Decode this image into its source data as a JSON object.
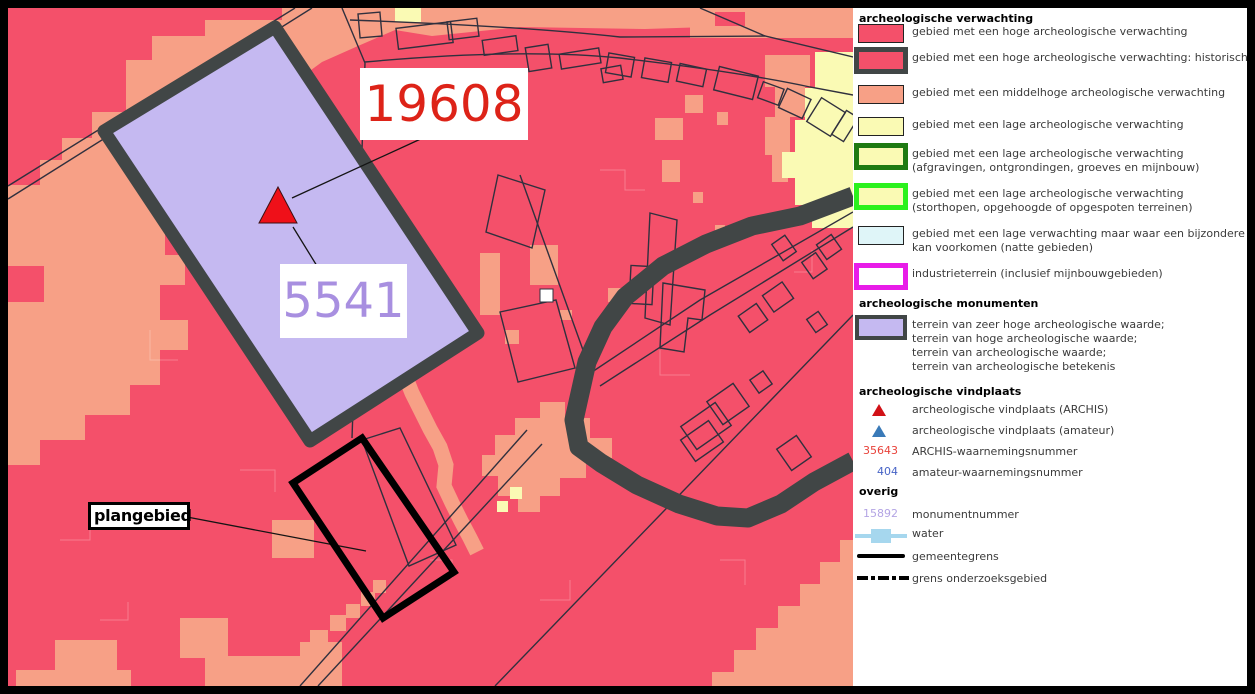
{
  "map": {
    "labels": {
      "archis_number": "19608",
      "monument_number": "5541",
      "plan_area": "plangebied"
    },
    "colors": {
      "high_expectation_red": "#f4506a",
      "medium_expectation_salmon": "#f7a086",
      "low_expectation_yellow": "#fafab4",
      "wet_area_cyan": "#dff5f8",
      "monument_purple": "#c5b9f1",
      "historic_core_gray": "#414646",
      "industrial_magenta": "#e81ce8",
      "low_mining_darkgreen": "#1e7a12",
      "low_raised_green": "#2bf11c",
      "water_blue": "#a6d7ee",
      "archis_number_red": "#dd2318",
      "amateur_number_blue": "#4663c6",
      "monument_number_purple": "#b3a4e4"
    }
  },
  "legend": {
    "sections": [
      {
        "title": "archeologische verwachting",
        "items": [
          {
            "swatch": "red-fill-swatch",
            "label": "gebied met een hoge archeologische verwachting"
          },
          {
            "swatch": "red-fill-darkgray-border-swatch",
            "label": "gebied met een hoge archeologische verwachting: historische (dorps-)kernen"
          },
          {
            "swatch": "salmon-fill-swatch",
            "label": "gebied met een middelhoge archeologische verwachting"
          },
          {
            "swatch": "yellow-fill-swatch",
            "label": "gebied met een lage archeologische verwachting"
          },
          {
            "swatch": "yellow-fill-darkgreen-border-swatch",
            "label": "gebied met een lage archeologische verwachting",
            "label2": "(afgravingen, ontgrondingen, groeves en mijnbouw)"
          },
          {
            "swatch": "yellow-fill-green-border-swatch",
            "label": "gebied met een lage archeologische verwachting",
            "label2": "(storthopen, opgehoogde of opgespoten terreinen)"
          },
          {
            "swatch": "cyan-fill-swatch",
            "label": "gebied met een lage verwachting maar waar een bijzondere dataset",
            "label2": "kan voorkomen (natte gebieden)"
          },
          {
            "swatch": "white-fill-magenta-border-swatch",
            "label": "industrieterrein (inclusief mijnbouwgebieden)"
          }
        ]
      },
      {
        "title": "archeologische monumenten",
        "items": [
          {
            "swatch": "purple-fill-darkgray-border-swatch",
            "line1": "terrein van zeer hoge archeologische waarde;",
            "line2": "terrein van hoge archeologische waarde;",
            "line3": "terrein van archeologische waarde;",
            "line4": "terrein van archeologische betekenis"
          }
        ]
      },
      {
        "title": "archeologische vindplaats",
        "items": [
          {
            "symbol": "red-triangle-icon",
            "label": "archeologische vindplaats (ARCHIS)"
          },
          {
            "symbol": "blue-triangle-icon",
            "label": "archeologische vindplaats (amateur)"
          },
          {
            "value": "35643",
            "label": "ARCHIS-waarnemingsnummer"
          },
          {
            "value": "404",
            "label": "amateur-waarnemingsnummer"
          }
        ]
      },
      {
        "title": "overig",
        "items": [
          {
            "value": "15892",
            "label": "monumentnummer"
          },
          {
            "symbol": "water-line-icon",
            "label": "water"
          },
          {
            "symbol": "solid-line-icon",
            "label": "gemeentegrens"
          },
          {
            "symbol": "dash-dot-line-icon",
            "label": "grens onderzoeksgebied"
          }
        ]
      }
    ]
  }
}
